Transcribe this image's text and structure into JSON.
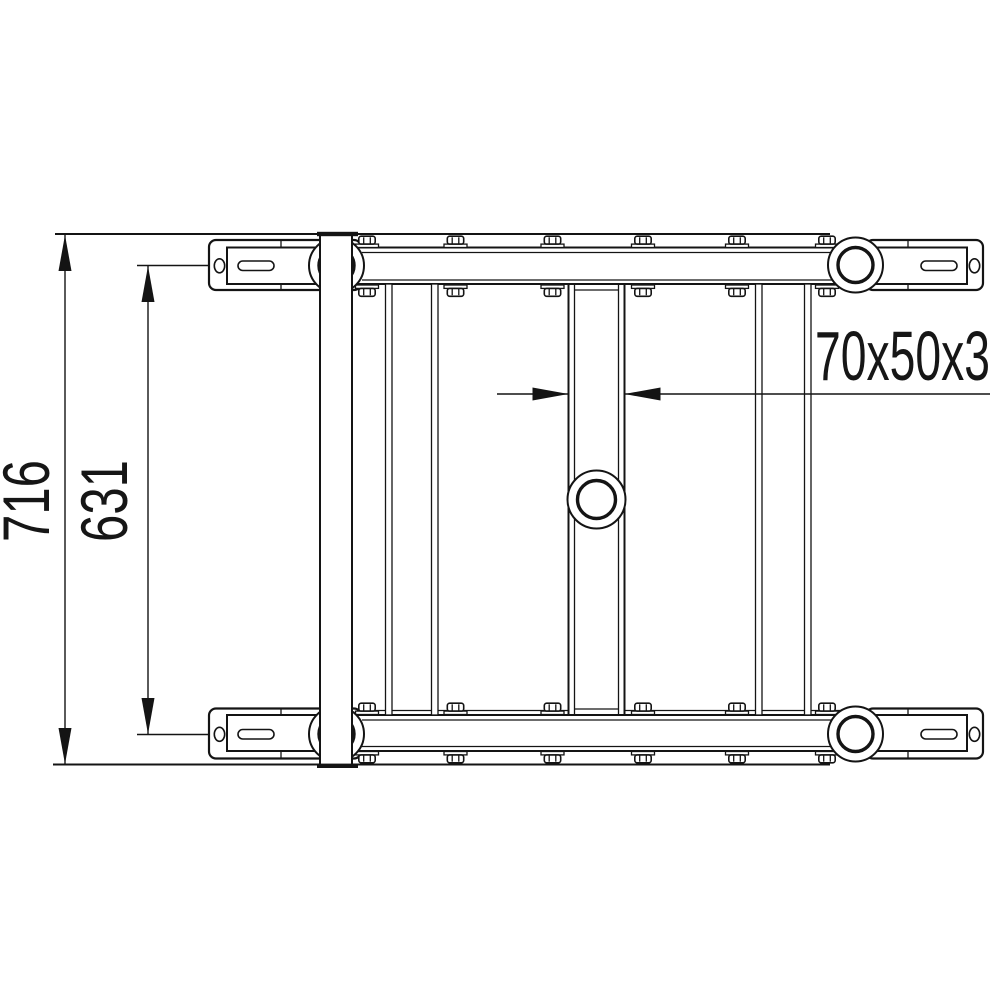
{
  "meta": {
    "paper_color": "#ffffff",
    "ink_color": "#141414",
    "drawing_type": "technical-orthographic-view"
  },
  "dimensions": {
    "overall_height": {
      "label": "716"
    },
    "inner_height": {
      "label": "631"
    },
    "tube_profile": {
      "label": "70x50x3"
    }
  }
}
